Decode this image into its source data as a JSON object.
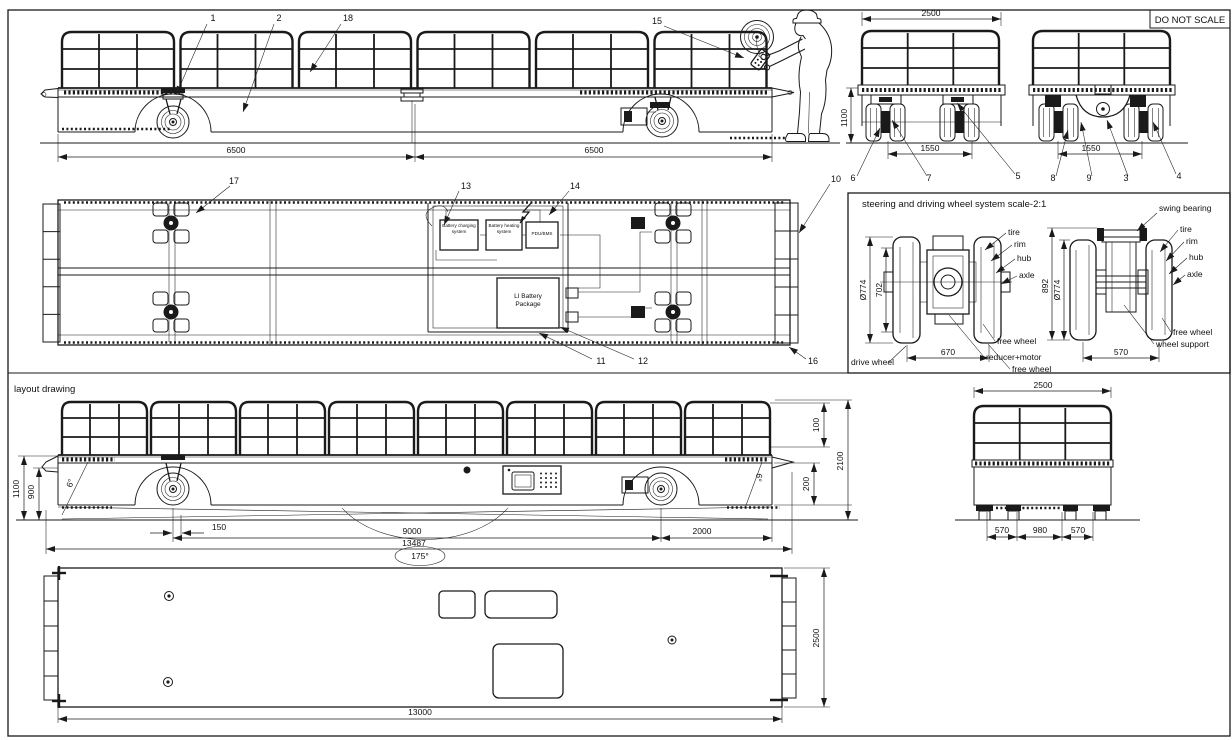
{
  "colors": {
    "line": "#1a1a1a",
    "background": "#ffffff"
  },
  "note": {
    "do_not_scale": "DO NOT SCALE"
  },
  "side_view": {
    "callout_1": "1",
    "callout_2": "2",
    "callout_18": "18",
    "callout_15": "15",
    "dim_front": "6500",
    "dim_rear": "6500"
  },
  "end_view_front": {
    "dim_width": "2500",
    "dim_height": "1100",
    "dim_track": "1550",
    "callout_6": "6",
    "callout_7": "7",
    "callout_5": "5"
  },
  "end_view_rear": {
    "dim_track": "1550",
    "callout_8": "8",
    "callout_9": "9",
    "callout_3": "3",
    "callout_4": "4"
  },
  "plan_view": {
    "callout_17": "17",
    "callout_13": "13",
    "callout_14": "14",
    "callout_10": "10",
    "callout_11": "11",
    "callout_12": "12",
    "callout_16": "16",
    "box_charging": "Battery charging system",
    "box_heating": "Battery heating system",
    "box_pdu": "PDU/BMS",
    "box_battery": "LI Battery Package"
  },
  "wheel_detail": {
    "title": "steering and driving wheel system  scale-2:1",
    "drive_unit": {
      "dim_dia": "Ø774",
      "dim_inner": "702",
      "dim_track": "670",
      "lbl_tire": "tire",
      "lbl_rim": "rim",
      "lbl_hub": "hub",
      "lbl_axle": "axle",
      "lbl_free_wheel_upper": "free wheel",
      "lbl_reducer_motor": "reducer+motor",
      "lbl_free_wheel_lower": "free wheel",
      "lbl_drive_wheel": "drive wheel"
    },
    "swing_unit": {
      "lbl_swing_bearing": "swing bearing",
      "dim_height": "892",
      "dim_dia": "Ø774",
      "dim_track": "570",
      "lbl_tire": "tire",
      "lbl_rim": "rim",
      "lbl_hub": "hub",
      "lbl_axle": "axle",
      "lbl_free_wheel": "free wheel",
      "lbl_wheel_support": "wheel support"
    }
  },
  "layout_view": {
    "title": "layout drawing",
    "dim_deck_height": "1100",
    "dim_side_height": "900",
    "angle_front": "6°",
    "dim_caster_offset": "150",
    "dim_wheelbase": "9000",
    "dim_overall_length": "13487",
    "angle_turn": "175°",
    "dim_rear_overhang": "2000",
    "dim_rail_top": "100",
    "dim_step": "200",
    "dim_total_height": "2100",
    "angle_rear": "6°"
  },
  "layout_end_view": {
    "dim_width": "2500",
    "dim_left": "570",
    "dim_center": "980",
    "dim_right": "570"
  },
  "underframe_plan": {
    "dim_length": "13000",
    "dim_width": "2500"
  }
}
